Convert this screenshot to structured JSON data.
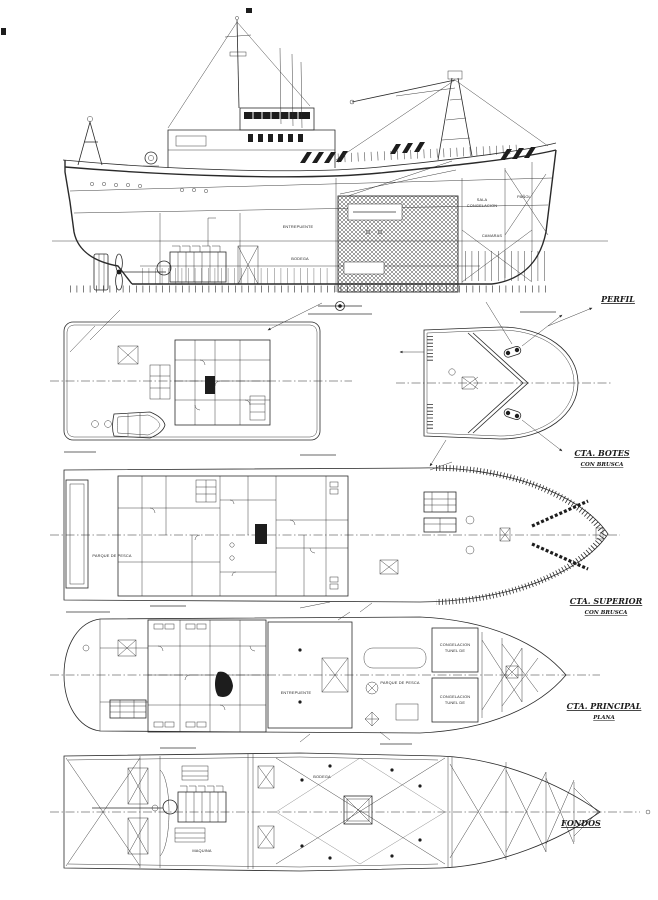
{
  "sheet": {
    "paper_color": "#ffffff",
    "ink_color": "#2a2a2a",
    "type": "general-arrangement-drawing"
  },
  "views": {
    "perfil": {
      "label": "PERFIL",
      "rooms": {
        "entrepuente": "ENTREPUENTE",
        "bodega": "BODEGA",
        "sala": "SALA",
        "congelacion": "CONGELACION",
        "camaras": "CAMARAS",
        "panol": "PAÑOL"
      }
    },
    "cta_botes": {
      "label": "CTA. BOTES",
      "sublabel": "CON BRUSCA"
    },
    "cta_superior": {
      "label": "CTA. SUPERIOR",
      "sublabel": "CON BRUSCA",
      "rooms": {
        "parque_de_pesca": "PARQUE DE PESCA"
      }
    },
    "cta_principal": {
      "label": "CTA. PRINCIPAL",
      "sublabel": "PLANA",
      "rooms": {
        "entrepuente": "ENTREPUENTE",
        "parque_de_pesca": "PARQUE DE PESCA",
        "congelacion_line1": "CONGELACION",
        "congelacion_line2": "TUNEL DE"
      }
    },
    "fondos": {
      "label": "FONDOS",
      "rooms": {
        "maquina": "MAQUINA",
        "bodega": "BODEGA"
      }
    }
  }
}
